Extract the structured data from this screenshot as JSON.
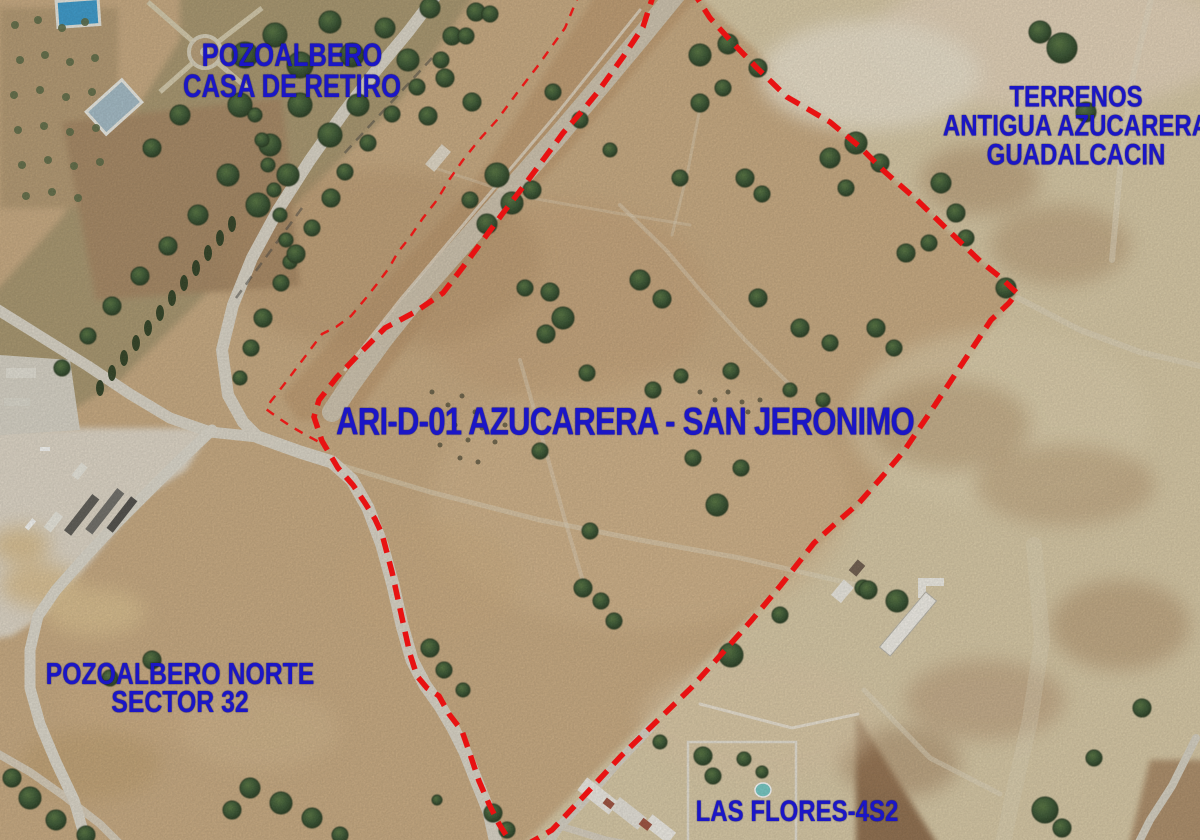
{
  "map": {
    "title": "ARI-D-01 AZUCARERA - SAN JERONIMO",
    "type": "aerial-orthophoto-with-planning-annotations"
  },
  "labels": {
    "park": {
      "line1": "POZOALBERO",
      "line2": "CASA DE RETIRO"
    },
    "terrenos": {
      "line1": "TERRENOS",
      "line2": "ANTIGUA AZUCARERA",
      "line3": "GUADALCACIN"
    },
    "main": {
      "text": "ARI-D-01 AZUCARERA - SAN JERONIMO"
    },
    "norte": {
      "line1": "POZOALBERO NORTE",
      "line2": "SECTOR 32"
    },
    "flores": {
      "text": "LAS FLORES-4S2"
    }
  },
  "colors": {
    "annotation_blue": "#1b16c6",
    "boundary_red": "#e81212",
    "terrain_tan": "#c9a97d"
  },
  "boundary": {
    "main_points": "655,-10 643,27 623,57 597,93 583,110 563,133 543,160 523,187 503,213 483,240 463,267 443,293 415,312 385,328 362,351 337,377 319,400 314,417 322,441 338,468 353,485 365,503 375,519 382,534 392,572 399,604 404,627 410,654 417,676 427,688 439,696 449,714 462,731 470,754 479,781 489,804 499,824 511,843 514,852 552,830 584,796 621,756 656,722 691,688 718,658 751,621 781,585 814,543 836,523 859,503 881,478 904,451 931,411 964,361 991,320 1009,303 1017,293 1000,277 980,261 950,232 917,200 885,172 860,147 830,122 787,97 757,68 730,40 710,18 692,-10",
    "secondary_points": "580,-8 565,28 537,67 517,93 497,120 479,140 463,160 449,180 437,200 423,218 410,237 398,252 389,268 377,284 366,298 351,316 336,327 322,334 307,354 292,374 279,391 271,401 266,409 277,417 292,427 306,435 319,442"
  }
}
